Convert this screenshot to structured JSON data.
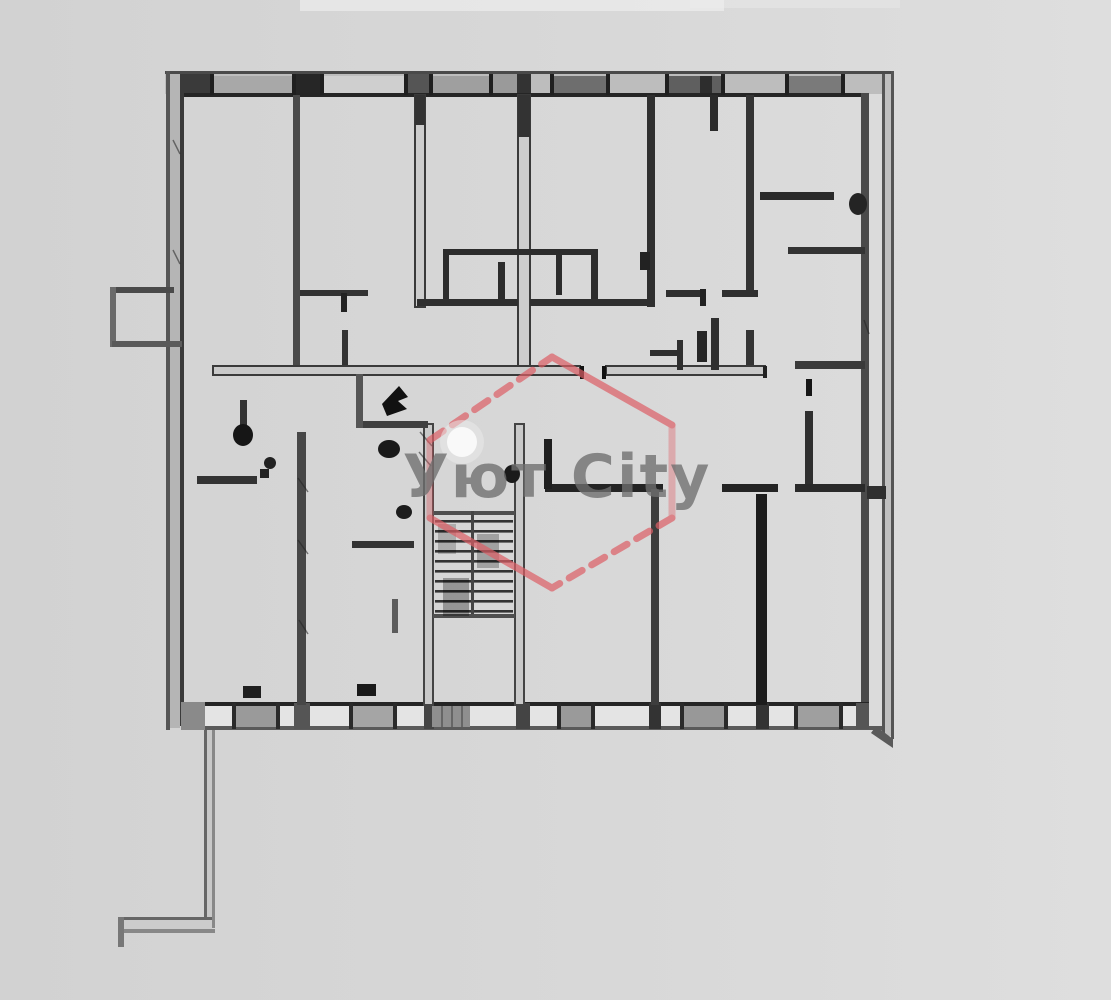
{
  "meta": {
    "canvas_width": 1111,
    "canvas_height": 1000,
    "content_type": "apartment floor plan scan"
  },
  "background": {
    "color": "#d8d8d8"
  },
  "drawing": {
    "type": "floor-plan",
    "wall_color": "#2f2f2f",
    "outer_wall_color": "#4a4a4a",
    "double_wall_core_color": "#cdcdcd",
    "window_fill_color": "#9a9a9a",
    "top_windows": 6,
    "bottom_windows": 5,
    "staircase": {
      "treads": 10,
      "location": "center"
    }
  },
  "watermark": {
    "text": "Уют City",
    "text_color": "#6f6f6f",
    "brand_color": "#dd5f66",
    "shape": "hexagon"
  }
}
